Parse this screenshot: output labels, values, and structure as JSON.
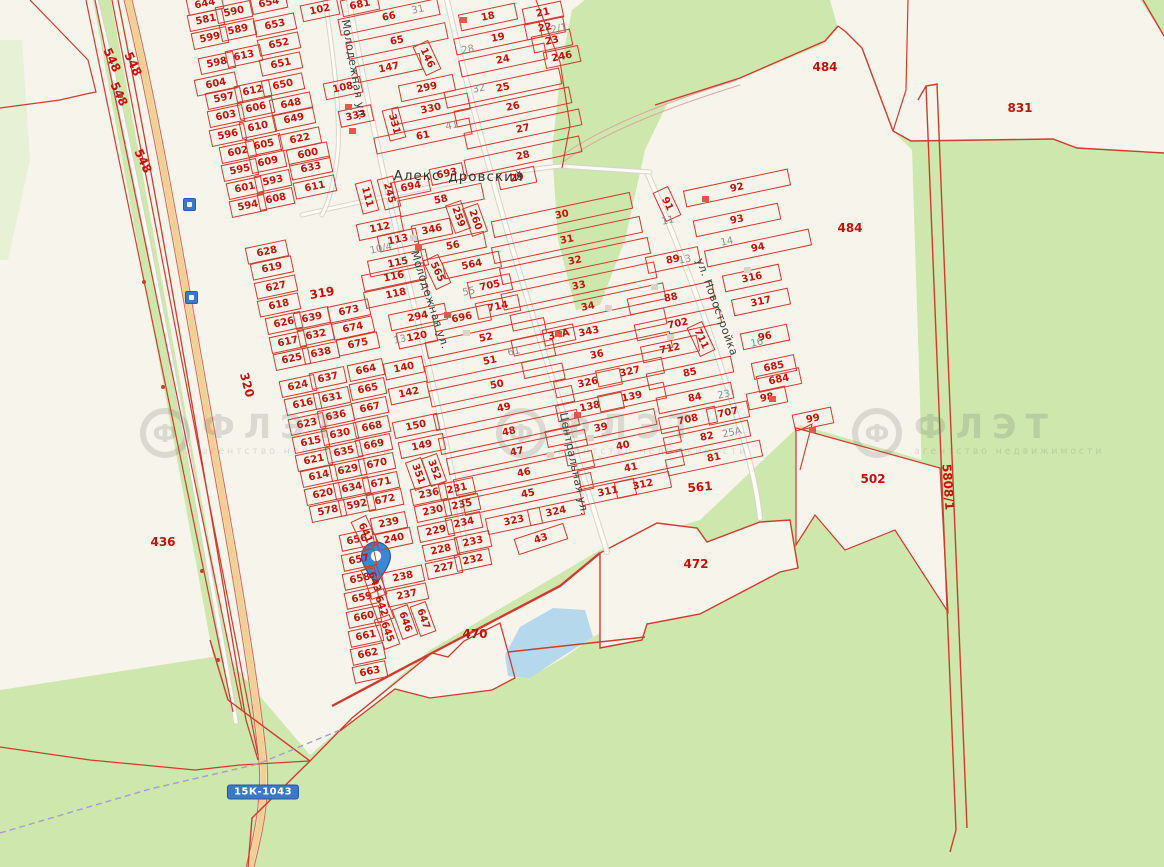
{
  "map_title": "Cadastral map with location pin",
  "road_badge": {
    "text": "15К-1043",
    "x": 263,
    "y": 792
  },
  "pin": {
    "x": 376,
    "y": 557
  },
  "place_labels": [
    {
      "t": "Алекс",
      "x": 417,
      "y": 176
    },
    {
      "t": "дровский",
      "x": 486,
      "y": 177
    }
  ],
  "street_labels": [
    {
      "t": "Молодежная ул.",
      "x": 354,
      "y": 70,
      "r": 80
    },
    {
      "t": "Молодежная ул.",
      "x": 430,
      "y": 300,
      "r": 72
    },
    {
      "t": "ул. Новостройка",
      "x": 717,
      "y": 307,
      "r": 70
    },
    {
      "t": "Центральная ул.",
      "x": 574,
      "y": 464,
      "r": 78
    }
  ],
  "watermark": {
    "logo": "Ф",
    "name": "ФЛЭТ",
    "subtitle": "агентство недвижимости",
    "positions": [
      {
        "x": 140,
        "y": 408
      },
      {
        "x": 496,
        "y": 408
      },
      {
        "x": 852,
        "y": 408
      }
    ]
  },
  "area_labels": [
    {
      "t": "548",
      "x": 112,
      "y": 60,
      "r": 65
    },
    {
      "t": "548",
      "x": 133,
      "y": 64,
      "r": 65
    },
    {
      "t": "548",
      "x": 119,
      "y": 94,
      "r": 65
    },
    {
      "t": "548",
      "x": 143,
      "y": 161,
      "r": 65
    },
    {
      "t": "319",
      "x": 322,
      "y": 293,
      "r": -10
    },
    {
      "t": "320",
      "x": 247,
      "y": 385,
      "r": 75
    },
    {
      "t": "436",
      "x": 163,
      "y": 542,
      "r": 0
    },
    {
      "t": "470",
      "x": 475,
      "y": 634,
      "r": 0
    },
    {
      "t": "472",
      "x": 696,
      "y": 564,
      "r": 0
    },
    {
      "t": "484",
      "x": 825,
      "y": 67,
      "r": 0
    },
    {
      "t": "484",
      "x": 850,
      "y": 228,
      "r": 0
    },
    {
      "t": "502",
      "x": 873,
      "y": 479,
      "r": 0
    },
    {
      "t": "561",
      "x": 700,
      "y": 487,
      "r": -5
    },
    {
      "t": "831",
      "x": 1020,
      "y": 108,
      "r": 0
    },
    {
      "t": "5808/1",
      "x": 948,
      "y": 487,
      "r": 86
    }
  ],
  "grey_labels": [
    {
      "t": "31",
      "x": 418,
      "y": 10
    },
    {
      "t": "28",
      "x": 468,
      "y": 50
    },
    {
      "t": "32",
      "x": 479,
      "y": 89
    },
    {
      "t": "41",
      "x": 452,
      "y": 126
    },
    {
      "t": "2/1",
      "x": 559,
      "y": 29
    },
    {
      "t": "10/4",
      "x": 381,
      "y": 249
    },
    {
      "t": "13",
      "x": 400,
      "y": 340
    },
    {
      "t": "55",
      "x": 469,
      "y": 292
    },
    {
      "t": "61",
      "x": 514,
      "y": 352
    },
    {
      "t": "11",
      "x": 668,
      "y": 221
    },
    {
      "t": "13",
      "x": 685,
      "y": 260
    },
    {
      "t": "14",
      "x": 727,
      "y": 242
    },
    {
      "t": "16",
      "x": 757,
      "y": 343
    },
    {
      "t": "23",
      "x": 724,
      "y": 395
    },
    {
      "t": "25А",
      "x": 732,
      "y": 433
    }
  ],
  "parcels": [
    {
      "t": "644",
      "x": 205,
      "y": 4,
      "w": 34
    },
    {
      "t": "654",
      "x": 269,
      "y": 3,
      "w": 34
    },
    {
      "t": "581",
      "x": 206,
      "y": 20,
      "w": 34
    },
    {
      "t": "590",
      "x": 234,
      "y": 12,
      "w": 34
    },
    {
      "t": "599",
      "x": 210,
      "y": 38,
      "w": 34
    },
    {
      "t": "589",
      "x": 238,
      "y": 30,
      "w": 34
    },
    {
      "t": "653",
      "x": 275,
      "y": 25,
      "w": 40
    },
    {
      "t": "652",
      "x": 279,
      "y": 44,
      "w": 40
    },
    {
      "t": "598",
      "x": 217,
      "y": 63,
      "w": 34
    },
    {
      "t": "613",
      "x": 244,
      "y": 56,
      "w": 34
    },
    {
      "t": "651",
      "x": 281,
      "y": 64,
      "w": 40
    },
    {
      "t": "604",
      "x": 216,
      "y": 84,
      "w": 40
    },
    {
      "t": "650",
      "x": 283,
      "y": 85,
      "w": 40
    },
    {
      "t": "597",
      "x": 224,
      "y": 98,
      "w": 34
    },
    {
      "t": "612",
      "x": 253,
      "y": 91,
      "w": 34
    },
    {
      "t": "648",
      "x": 291,
      "y": 104,
      "w": 40
    },
    {
      "t": "603",
      "x": 226,
      "y": 116,
      "w": 34
    },
    {
      "t": "606",
      "x": 256,
      "y": 108,
      "w": 34
    },
    {
      "t": "649",
      "x": 294,
      "y": 119,
      "w": 40
    },
    {
      "t": "596",
      "x": 228,
      "y": 135,
      "w": 34
    },
    {
      "t": "610",
      "x": 258,
      "y": 127,
      "w": 34
    },
    {
      "t": "622",
      "x": 300,
      "y": 139,
      "w": 40
    },
    {
      "t": "602",
      "x": 238,
      "y": 152,
      "w": 34
    },
    {
      "t": "605",
      "x": 264,
      "y": 145,
      "w": 34
    },
    {
      "t": "600",
      "x": 308,
      "y": 154,
      "w": 40
    },
    {
      "t": "595",
      "x": 240,
      "y": 170,
      "w": 34
    },
    {
      "t": "609",
      "x": 268,
      "y": 162,
      "w": 34
    },
    {
      "t": "633",
      "x": 311,
      "y": 168,
      "w": 40
    },
    {
      "t": "601",
      "x": 245,
      "y": 188,
      "w": 34
    },
    {
      "t": "593",
      "x": 273,
      "y": 181,
      "w": 34
    },
    {
      "t": "611",
      "x": 315,
      "y": 187,
      "w": 40
    },
    {
      "t": "594",
      "x": 248,
      "y": 206,
      "w": 34
    },
    {
      "t": "608",
      "x": 276,
      "y": 199,
      "w": 34
    },
    {
      "t": "102",
      "x": 320,
      "y": 10,
      "w": 36
    },
    {
      "t": "681",
      "x": 360,
      "y": 5,
      "w": 36
    },
    {
      "t": "108",
      "x": 343,
      "y": 88,
      "w": 36
    },
    {
      "t": "333",
      "x": 356,
      "y": 116,
      "w": 32
    },
    {
      "t": "111",
      "x": 367,
      "y": 197,
      "w": 30,
      "r": 75
    },
    {
      "t": "245",
      "x": 389,
      "y": 193,
      "w": 30,
      "r": 75
    },
    {
      "t": "66",
      "x": 389,
      "y": 17,
      "w": 100
    },
    {
      "t": "65",
      "x": 397,
      "y": 41,
      "w": 100
    },
    {
      "t": "147",
      "x": 389,
      "y": 68,
      "w": 64
    },
    {
      "t": "146",
      "x": 427,
      "y": 58,
      "w": 30,
      "r": 65
    },
    {
      "t": "299",
      "x": 427,
      "y": 88,
      "w": 54
    },
    {
      "t": "330",
      "x": 431,
      "y": 109,
      "w": 76
    },
    {
      "t": "331",
      "x": 394,
      "y": 124,
      "w": 30,
      "r": 75
    },
    {
      "t": "61",
      "x": 423,
      "y": 136,
      "w": 96
    },
    {
      "t": "694",
      "x": 411,
      "y": 187,
      "w": 36
    },
    {
      "t": "693",
      "x": 447,
      "y": 174,
      "w": 32
    },
    {
      "t": "58",
      "x": 441,
      "y": 200,
      "w": 84
    },
    {
      "t": "112",
      "x": 380,
      "y": 228,
      "w": 44
    },
    {
      "t": "113",
      "x": 398,
      "y": 240,
      "w": 38
    },
    {
      "t": "115",
      "x": 398,
      "y": 263,
      "w": 58
    },
    {
      "t": "116",
      "x": 394,
      "y": 277,
      "w": 62
    },
    {
      "t": "118",
      "x": 396,
      "y": 294,
      "w": 62
    },
    {
      "t": "294",
      "x": 418,
      "y": 317,
      "w": 56
    },
    {
      "t": "120",
      "x": 417,
      "y": 337,
      "w": 38
    },
    {
      "t": "140",
      "x": 404,
      "y": 368,
      "w": 38
    },
    {
      "t": "142",
      "x": 409,
      "y": 393,
      "w": 38
    },
    {
      "t": "150",
      "x": 416,
      "y": 426,
      "w": 44
    },
    {
      "t": "149",
      "x": 422,
      "y": 446,
      "w": 44
    },
    {
      "t": "351",
      "x": 418,
      "y": 474,
      "w": 28,
      "r": 70
    },
    {
      "t": "352",
      "x": 434,
      "y": 470,
      "w": 28,
      "r": 70
    },
    {
      "t": "346",
      "x": 432,
      "y": 230,
      "w": 38
    },
    {
      "t": "56",
      "x": 453,
      "y": 246,
      "w": 64
    },
    {
      "t": "565",
      "x": 437,
      "y": 272,
      "w": 30,
      "r": 65
    },
    {
      "t": "564",
      "x": 472,
      "y": 265,
      "w": 56
    },
    {
      "t": "705",
      "x": 490,
      "y": 286,
      "w": 42
    },
    {
      "t": "714",
      "x": 498,
      "y": 307,
      "w": 42
    },
    {
      "t": "696",
      "x": 462,
      "y": 318,
      "w": 56
    },
    {
      "t": "52",
      "x": 486,
      "y": 338,
      "w": 120
    },
    {
      "t": "51",
      "x": 490,
      "y": 361,
      "w": 130
    },
    {
      "t": "50",
      "x": 497,
      "y": 385,
      "w": 135
    },
    {
      "t": "49",
      "x": 504,
      "y": 408,
      "w": 140
    },
    {
      "t": "48",
      "x": 509,
      "y": 432,
      "w": 140
    },
    {
      "t": "47",
      "x": 517,
      "y": 452,
      "w": 140
    },
    {
      "t": "46",
      "x": 524,
      "y": 473,
      "w": 140
    },
    {
      "t": "45",
      "x": 528,
      "y": 494,
      "w": 130
    },
    {
      "t": "323",
      "x": 514,
      "y": 521,
      "w": 54
    },
    {
      "t": "324",
      "x": 556,
      "y": 512,
      "w": 54
    },
    {
      "t": "43",
      "x": 541,
      "y": 539,
      "w": 50,
      "r": -18
    },
    {
      "t": "259",
      "x": 458,
      "y": 217,
      "w": 28,
      "r": 70
    },
    {
      "t": "260",
      "x": 475,
      "y": 220,
      "w": 28,
      "r": 70
    },
    {
      "t": "628",
      "x": 267,
      "y": 252,
      "w": 40
    },
    {
      "t": "619",
      "x": 272,
      "y": 268,
      "w": 40
    },
    {
      "t": "627",
      "x": 276,
      "y": 287,
      "w": 40
    },
    {
      "t": "618",
      "x": 279,
      "y": 305,
      "w": 40
    },
    {
      "t": "626",
      "x": 284,
      "y": 323,
      "w": 34
    },
    {
      "t": "617",
      "x": 288,
      "y": 342,
      "w": 34
    },
    {
      "t": "625",
      "x": 292,
      "y": 359,
      "w": 34
    },
    {
      "t": "639",
      "x": 312,
      "y": 318,
      "w": 34
    },
    {
      "t": "632",
      "x": 316,
      "y": 335,
      "w": 34
    },
    {
      "t": "638",
      "x": 321,
      "y": 353,
      "w": 34
    },
    {
      "t": "673",
      "x": 349,
      "y": 311,
      "w": 40
    },
    {
      "t": "674",
      "x": 353,
      "y": 328,
      "w": 40
    },
    {
      "t": "675",
      "x": 358,
      "y": 344,
      "w": 40
    },
    {
      "t": "624",
      "x": 298,
      "y": 386,
      "w": 34
    },
    {
      "t": "637",
      "x": 328,
      "y": 378,
      "w": 34
    },
    {
      "t": "616",
      "x": 303,
      "y": 404,
      "w": 34
    },
    {
      "t": "631",
      "x": 332,
      "y": 398,
      "w": 34
    },
    {
      "t": "623",
      "x": 307,
      "y": 424,
      "w": 34
    },
    {
      "t": "636",
      "x": 336,
      "y": 416,
      "w": 34
    },
    {
      "t": "615",
      "x": 311,
      "y": 442,
      "w": 34
    },
    {
      "t": "630",
      "x": 340,
      "y": 434,
      "w": 34
    },
    {
      "t": "621",
      "x": 314,
      "y": 460,
      "w": 34
    },
    {
      "t": "635",
      "x": 344,
      "y": 452,
      "w": 34
    },
    {
      "t": "614",
      "x": 319,
      "y": 476,
      "w": 34
    },
    {
      "t": "629",
      "x": 348,
      "y": 470,
      "w": 34
    },
    {
      "t": "620",
      "x": 323,
      "y": 494,
      "w": 34
    },
    {
      "t": "634",
      "x": 352,
      "y": 488,
      "w": 34
    },
    {
      "t": "578",
      "x": 328,
      "y": 511,
      "w": 34
    },
    {
      "t": "592",
      "x": 357,
      "y": 505,
      "w": 34
    },
    {
      "t": "664",
      "x": 366,
      "y": 370,
      "w": 34
    },
    {
      "t": "665",
      "x": 368,
      "y": 389,
      "w": 34
    },
    {
      "t": "667",
      "x": 370,
      "y": 408,
      "w": 34
    },
    {
      "t": "668",
      "x": 372,
      "y": 427,
      "w": 34
    },
    {
      "t": "669",
      "x": 374,
      "y": 445,
      "w": 34
    },
    {
      "t": "670",
      "x": 377,
      "y": 464,
      "w": 34
    },
    {
      "t": "671",
      "x": 381,
      "y": 483,
      "w": 34
    },
    {
      "t": "672",
      "x": 385,
      "y": 500,
      "w": 34
    },
    {
      "t": "656",
      "x": 357,
      "y": 540,
      "w": 32
    },
    {
      "t": "657",
      "x": 359,
      "y": 560,
      "w": 32
    },
    {
      "t": "658",
      "x": 360,
      "y": 579,
      "w": 32
    },
    {
      "t": "659",
      "x": 362,
      "y": 598,
      "w": 32
    },
    {
      "t": "660",
      "x": 364,
      "y": 617,
      "w": 32
    },
    {
      "t": "661",
      "x": 366,
      "y": 636,
      "w": 32
    },
    {
      "t": "662",
      "x": 368,
      "y": 654,
      "w": 32
    },
    {
      "t": "663",
      "x": 370,
      "y": 672,
      "w": 32
    },
    {
      "t": "239",
      "x": 389,
      "y": 523,
      "w": 34
    },
    {
      "t": "240",
      "x": 394,
      "y": 539,
      "w": 34
    },
    {
      "t": "641",
      "x": 365,
      "y": 533,
      "w": 30,
      "r": 65
    },
    {
      "t": "643",
      "x": 374,
      "y": 582,
      "w": 30,
      "r": 70
    },
    {
      "t": "642",
      "x": 381,
      "y": 606,
      "w": 30,
      "r": 70
    },
    {
      "t": "645",
      "x": 387,
      "y": 632,
      "w": 30,
      "r": 70
    },
    {
      "t": "646",
      "x": 405,
      "y": 622,
      "w": 30,
      "r": 70
    },
    {
      "t": "647",
      "x": 423,
      "y": 619,
      "w": 30,
      "r": 70
    },
    {
      "t": "238",
      "x": 403,
      "y": 577,
      "w": 40
    },
    {
      "t": "237",
      "x": 407,
      "y": 595,
      "w": 40
    },
    {
      "t": "236",
      "x": 429,
      "y": 494,
      "w": 34
    },
    {
      "t": "230",
      "x": 433,
      "y": 511,
      "w": 34
    },
    {
      "t": "229",
      "x": 436,
      "y": 531,
      "w": 34
    },
    {
      "t": "228",
      "x": 441,
      "y": 550,
      "w": 34
    },
    {
      "t": "227",
      "x": 444,
      "y": 568,
      "w": 34
    },
    {
      "t": "231",
      "x": 457,
      "y": 489,
      "w": 34
    },
    {
      "t": "235",
      "x": 462,
      "y": 505,
      "w": 34
    },
    {
      "t": "234",
      "x": 464,
      "y": 523,
      "w": 34
    },
    {
      "t": "233",
      "x": 473,
      "y": 542,
      "w": 34
    },
    {
      "t": "232",
      "x": 473,
      "y": 560,
      "w": 34
    },
    {
      "t": "18",
      "x": 488,
      "y": 17,
      "w": 56
    },
    {
      "t": "19",
      "x": 498,
      "y": 38,
      "w": 86
    },
    {
      "t": "24",
      "x": 503,
      "y": 60,
      "w": 86
    },
    {
      "t": "25",
      "x": 503,
      "y": 88,
      "w": 116
    },
    {
      "t": "26",
      "x": 513,
      "y": 107,
      "w": 116
    },
    {
      "t": "27",
      "x": 523,
      "y": 129,
      "w": 116
    },
    {
      "t": "28",
      "x": 523,
      "y": 156,
      "w": 116
    },
    {
      "t": "29",
      "x": 517,
      "y": 178,
      "w": 36
    },
    {
      "t": "21",
      "x": 543,
      "y": 13,
      "w": 38
    },
    {
      "t": "22",
      "x": 545,
      "y": 28,
      "w": 38
    },
    {
      "t": "23",
      "x": 552,
      "y": 41,
      "w": 38
    },
    {
      "t": "246",
      "x": 562,
      "y": 57,
      "w": 34
    },
    {
      "t": "30",
      "x": 562,
      "y": 215,
      "w": 140
    },
    {
      "t": "31",
      "x": 567,
      "y": 240,
      "w": 150
    },
    {
      "t": "32",
      "x": 575,
      "y": 261,
      "w": 150
    },
    {
      "t": "33",
      "x": 579,
      "y": 286,
      "w": 155
    },
    {
      "t": "34",
      "x": 588,
      "y": 307,
      "w": 155
    },
    {
      "t": "343",
      "x": 589,
      "y": 332,
      "w": 155
    },
    {
      "t": "34А",
      "x": 559,
      "y": 335,
      "w": 30
    },
    {
      "t": "36",
      "x": 597,
      "y": 355,
      "w": 150
    },
    {
      "t": "326",
      "x": 588,
      "y": 383,
      "w": 66
    },
    {
      "t": "327",
      "x": 630,
      "y": 372,
      "w": 66
    },
    {
      "t": "138",
      "x": 590,
      "y": 407,
      "w": 66
    },
    {
      "t": "139",
      "x": 632,
      "y": 397,
      "w": 66
    },
    {
      "t": "39",
      "x": 601,
      "y": 428,
      "w": 110
    },
    {
      "t": "40",
      "x": 623,
      "y": 446,
      "w": 115
    },
    {
      "t": "41",
      "x": 631,
      "y": 468,
      "w": 105
    },
    {
      "t": "311",
      "x": 608,
      "y": 492,
      "w": 54
    },
    {
      "t": "312",
      "x": 643,
      "y": 485,
      "w": 54
    },
    {
      "t": "92",
      "x": 737,
      "y": 188,
      "w": 105
    },
    {
      "t": "93",
      "x": 737,
      "y": 220,
      "w": 85
    },
    {
      "t": "94",
      "x": 758,
      "y": 248,
      "w": 105
    },
    {
      "t": "91",
      "x": 667,
      "y": 204,
      "w": 30,
      "r": 65
    },
    {
      "t": "89",
      "x": 673,
      "y": 260,
      "w": 52
    },
    {
      "t": "316",
      "x": 752,
      "y": 278,
      "w": 56
    },
    {
      "t": "317",
      "x": 761,
      "y": 302,
      "w": 56
    },
    {
      "t": "88",
      "x": 671,
      "y": 298,
      "w": 85
    },
    {
      "t": "702",
      "x": 678,
      "y": 324,
      "w": 85
    },
    {
      "t": "712",
      "x": 670,
      "y": 349,
      "w": 56
    },
    {
      "t": "711",
      "x": 701,
      "y": 339,
      "w": 30,
      "r": 65
    },
    {
      "t": "96",
      "x": 765,
      "y": 337,
      "w": 46
    },
    {
      "t": "685",
      "x": 774,
      "y": 367,
      "w": 42
    },
    {
      "t": "684",
      "x": 779,
      "y": 380,
      "w": 42
    },
    {
      "t": "85",
      "x": 690,
      "y": 373,
      "w": 85
    },
    {
      "t": "84",
      "x": 695,
      "y": 398,
      "w": 75
    },
    {
      "t": "707",
      "x": 728,
      "y": 413,
      "w": 40
    },
    {
      "t": "708",
      "x": 688,
      "y": 420,
      "w": 56
    },
    {
      "t": "98",
      "x": 767,
      "y": 398,
      "w": 38
    },
    {
      "t": "99",
      "x": 813,
      "y": 419,
      "w": 38
    },
    {
      "t": "82",
      "x": 707,
      "y": 437,
      "w": 85
    },
    {
      "t": "81",
      "x": 714,
      "y": 458,
      "w": 95
    }
  ],
  "buildings_red": [
    [
      348,
      107
    ],
    [
      352,
      131
    ],
    [
      463,
      20
    ],
    [
      418,
      247
    ],
    [
      447,
      315
    ],
    [
      558,
      334
    ],
    [
      577,
      415
    ],
    [
      705,
      199
    ],
    [
      772,
      399
    ],
    [
      812,
      430
    ]
  ],
  "buildings_grey": [
    [
      413,
      238
    ],
    [
      466,
      333
    ],
    [
      608,
      308
    ],
    [
      654,
      287
    ],
    [
      670,
      337
    ],
    [
      747,
      270
    ],
    [
      550,
      455
    ],
    [
      590,
      438
    ]
  ],
  "dots_red": [
    [
      121,
      96
    ],
    [
      144,
      282
    ],
    [
      163,
      387
    ],
    [
      202,
      571
    ],
    [
      218,
      660
    ]
  ],
  "colors": {
    "red_line": "#cf3b2d",
    "red_text": "#c11309",
    "green": "#cde7ad",
    "pale_green": "#e7f1d6",
    "cream": "#f7f4ec",
    "lake": "#b5d8ec",
    "highway": "#f2cf92",
    "badge_blue": "#3c78c8",
    "pin_blue": "#3b87d4",
    "grey_text": "#8e8e89",
    "street_text": "#3e3e3a"
  }
}
